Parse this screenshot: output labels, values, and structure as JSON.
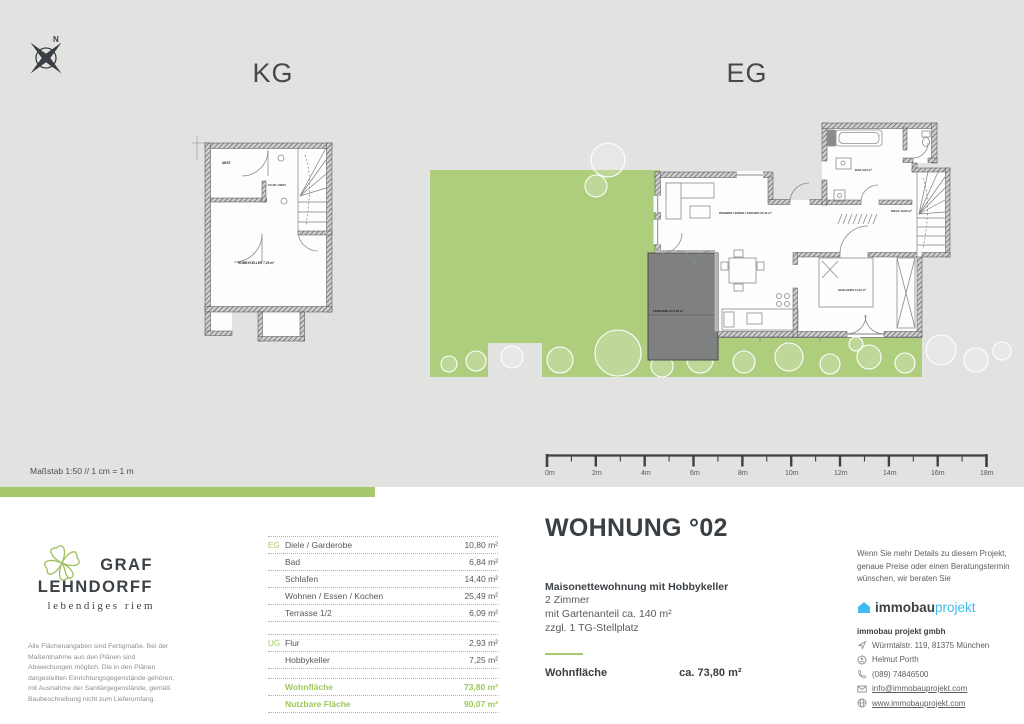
{
  "colors": {
    "panel_gray": "#e2e2e1",
    "garden_green": "#aecd7d",
    "accent_green": "#a6c96e",
    "text_dark": "#3d4246",
    "brand_blue": "#3ebcf0"
  },
  "compass": {
    "north": "N"
  },
  "plans": {
    "kg": {
      "heading": "KG",
      "labels": {
        "abst": "ABST.",
        "flur": "FLUR / ABST.",
        "hobby": "HOBBYKELLER 7,25 m²"
      }
    },
    "eg": {
      "heading": "EG",
      "labels": {
        "wohnen": "WOHNEN / ESSEN / KOCHEN 25,49 m²",
        "bad": "BAD 6,84 m²",
        "diele": "DIELE 10,80 m²",
        "schlafen": "SCHLAFEN 14,40 m²",
        "terrasse": "TERRASSE 1/2 6,09 m²"
      }
    }
  },
  "scale": {
    "note": "Maßstab 1:50 // 1 cm = 1 m",
    "labels": [
      "0m",
      "2m",
      "4m",
      "6m",
      "8m",
      "10m",
      "12m",
      "14m",
      "16m",
      "18m"
    ]
  },
  "apartment": {
    "title": "WOHNUNG °02",
    "headline": "Maisonettewohnung mit Hobbykeller",
    "line1": "2 Zimmer",
    "line2": "mit Gartenanteil ca. 140 m²",
    "line3": "zzgl. 1 TG-Stellplatz",
    "area_label": "Wohnfläche",
    "area_value": "ca. 73,80 m²"
  },
  "room_table": {
    "groups": [
      {
        "label": "EG",
        "rows": [
          [
            "Diele / Garderobe",
            "10,80 m²"
          ],
          [
            "Bad",
            "6,84 m²"
          ],
          [
            "Schlafen",
            "14,40 m²"
          ],
          [
            "Wohnen / Essen / Kochen",
            "25,49 m²"
          ],
          [
            "Terrasse 1/2",
            "6,09 m²"
          ]
        ]
      },
      {
        "label": "UG",
        "rows": [
          [
            "Flur",
            "2,93 m²"
          ],
          [
            "Hobbykeller",
            "7,25 m²"
          ]
        ]
      }
    ],
    "totals": [
      [
        "Wohnfläche",
        "73,80 m²"
      ],
      [
        "Nutzbare Fläche",
        "90,07 m²"
      ]
    ]
  },
  "brand": {
    "name1": "GRAF",
    "name2": "LEHNDORFF",
    "tagline": "lebendiges riem",
    "disclaimer": "Alle Flächenangaben sind Fertigmaße. Bei der Maßentnahme aus den Plänen sind Abweichungen möglich. Die in den Plänen dargestellten Einrichtungsgegenstände gehören, mit Ausnahme der Sanitärgegenstände, gemäß Baubeschreibung nicht zum Lieferumfang."
  },
  "contact": {
    "intro": "Wenn Sie mehr Details zu diesem Projekt, genaue Preise oder einen Beratungstermin wünschen, wir beraten Sie",
    "logo1": "immobau",
    "logo2": "projekt",
    "company": "immobau projekt gmbh",
    "address": "Würmtalstr. 119, 81375 München",
    "person": "Helmut Porth",
    "phone": "(089) 74846500",
    "email": "info@immobauprojekt.com",
    "website": "www.immobauprojekt.com"
  }
}
